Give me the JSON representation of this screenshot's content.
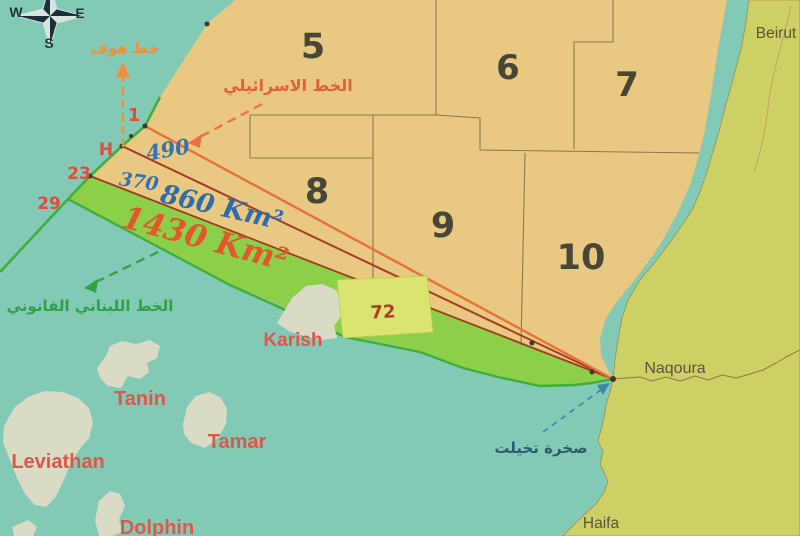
{
  "compass": {
    "west": "W",
    "east": "E",
    "south": "S"
  },
  "blocks": [
    {
      "label": "5"
    },
    {
      "label": "6"
    },
    {
      "label": "7"
    },
    {
      "label": "8"
    },
    {
      "label": "9"
    },
    {
      "label": "10"
    }
  ],
  "israeli_block": {
    "label": "72"
  },
  "maritime_lines": {
    "hof_line_label": "خط هوف",
    "israeli_line_label": "الخط الاسرائيلي",
    "lebanese_line_label": "الخط اللبناني القانوني",
    "point_1": "1",
    "point_h": "H",
    "point_23": "23",
    "point_29": "29"
  },
  "areas": {
    "area_490": "490",
    "area_370": "370",
    "area_860": "860 Km²",
    "area_1430": "1430 Km²"
  },
  "gas_fields": [
    {
      "name": "Karish"
    },
    {
      "name": "Tanin"
    },
    {
      "name": "Tamar"
    },
    {
      "name": "Leviathan"
    },
    {
      "name": "Dolphin"
    }
  ],
  "cities": [
    {
      "name": "Beirut"
    },
    {
      "name": "Naqoura"
    },
    {
      "name": "Haifa"
    }
  ],
  "landmarks": {
    "tekhelet_rock": "صخرة تخيلت"
  },
  "colors": {
    "sea": "#82cab6",
    "land": "#ccd065",
    "blocks_area": "#e9c882",
    "disputed_zone_1430": "#8ccf49",
    "block_72_fill": "#dce470",
    "gas_field_fill": "#d9dbc5",
    "israeli_line": "#e8713a",
    "hof_line": "#a63c28",
    "line_23": "#9c3c20",
    "lebanese_line": "#3fae3c",
    "area_label_blue": "#2f6cab",
    "area_label_orange": "#e2572b",
    "field_label_red": "#e0564a"
  }
}
